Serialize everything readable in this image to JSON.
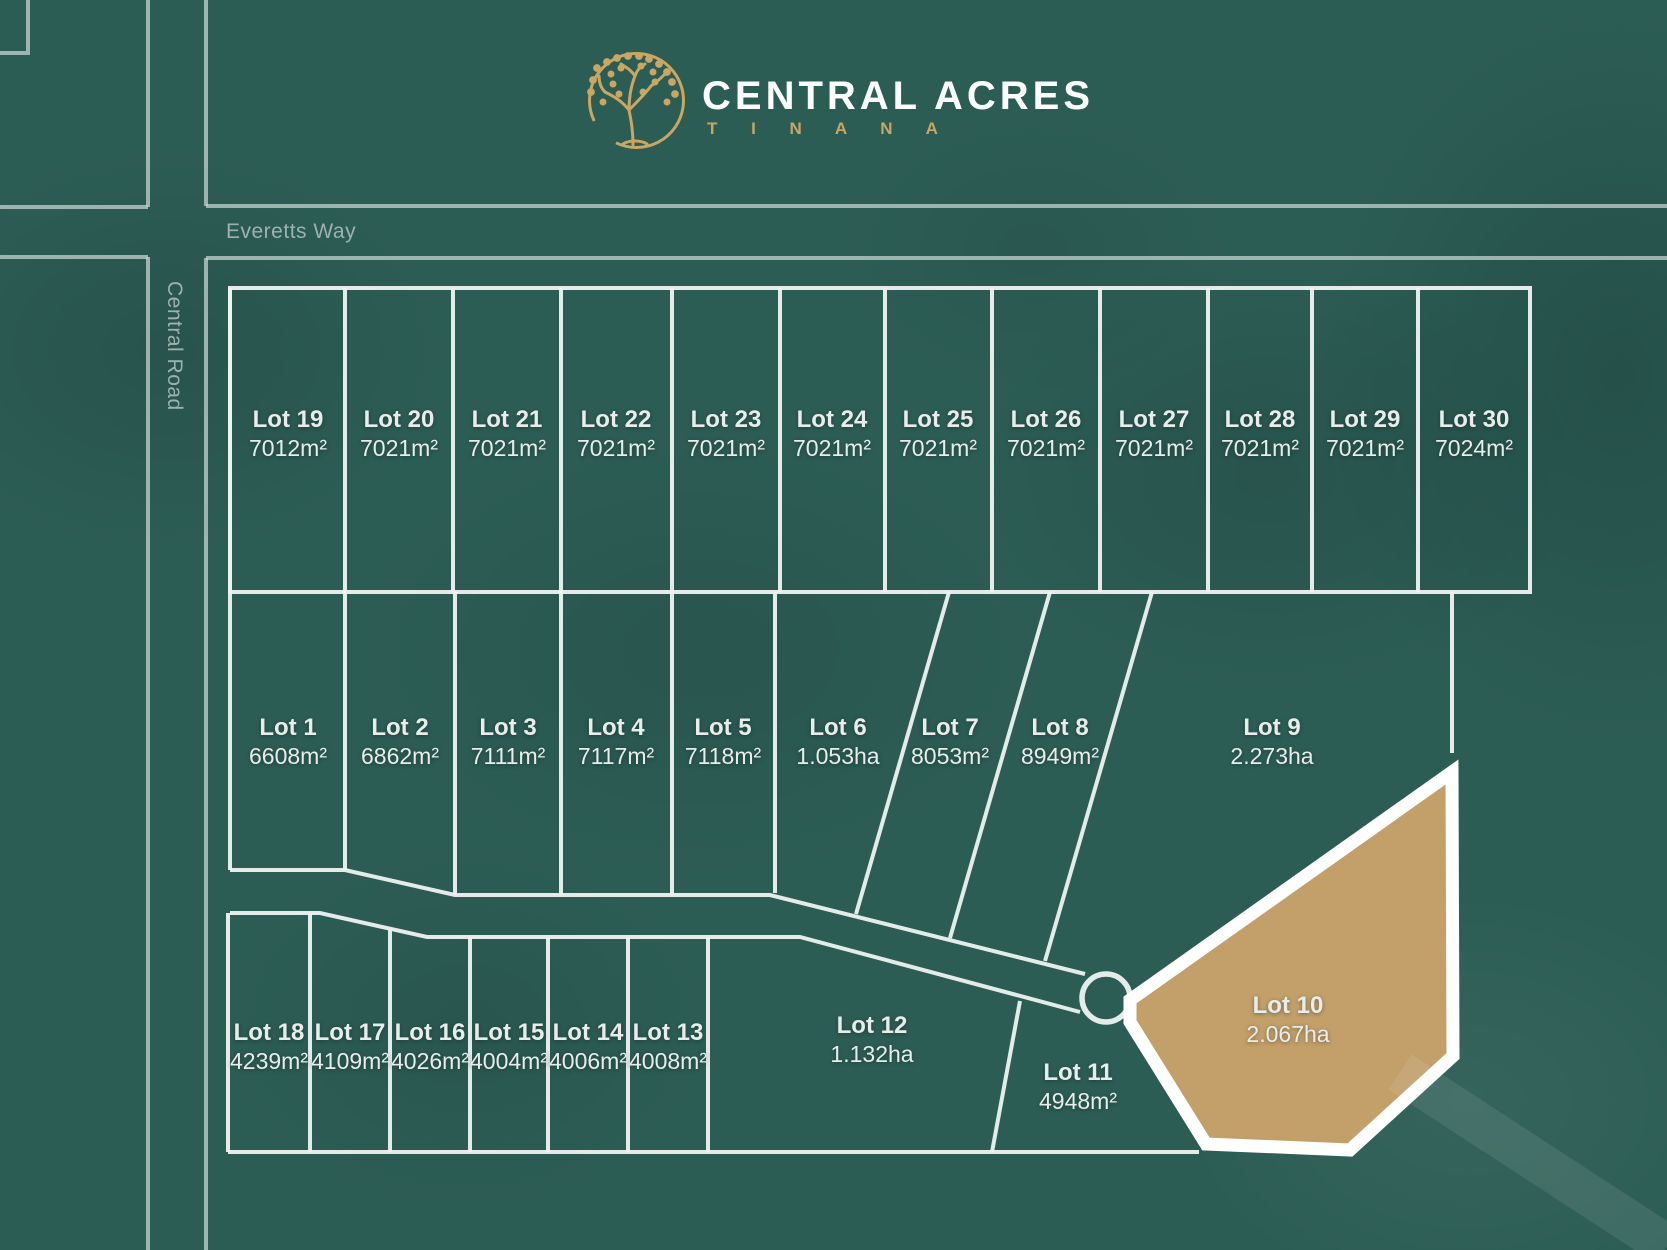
{
  "brand": {
    "title": "CENTRAL ACRES",
    "subtitle": "T I N A N A",
    "logo_icon": "tree-in-circle-icon",
    "gold": "#c9a662"
  },
  "roads": {
    "horizontal_label": "Everetts Way",
    "vertical_label": "Central Road"
  },
  "colors": {
    "background": "#2c5d55",
    "lot_boundary_line": "#eef3f2",
    "road_edge_line": "#c3d2cf",
    "road_label_text": "#9db2ae",
    "lot_label_text": "#e8edeb",
    "highlight_fill": "#c3a06a",
    "highlight_border": "#ffffff"
  },
  "lots": {
    "top": [
      {
        "name": "Lot 19",
        "area": "7012m²"
      },
      {
        "name": "Lot 20",
        "area": "7021m²"
      },
      {
        "name": "Lot 21",
        "area": "7021m²"
      },
      {
        "name": "Lot 22",
        "area": "7021m²"
      },
      {
        "name": "Lot 23",
        "area": "7021m²"
      },
      {
        "name": "Lot 24",
        "area": "7021m²"
      },
      {
        "name": "Lot 25",
        "area": "7021m²"
      },
      {
        "name": "Lot 26",
        "area": "7021m²"
      },
      {
        "name": "Lot 27",
        "area": "7021m²"
      },
      {
        "name": "Lot 28",
        "area": "7021m²"
      },
      {
        "name": "Lot 29",
        "area": "7021m²"
      },
      {
        "name": "Lot 30",
        "area": "7024m²"
      }
    ],
    "middle": [
      {
        "name": "Lot 1",
        "area": "6608m²"
      },
      {
        "name": "Lot 2",
        "area": "6862m²"
      },
      {
        "name": "Lot 3",
        "area": "7111m²"
      },
      {
        "name": "Lot 4",
        "area": "7117m²"
      },
      {
        "name": "Lot 5",
        "area": "7118m²"
      },
      {
        "name": "Lot 6",
        "area": "1.053ha"
      },
      {
        "name": "Lot 7",
        "area": "8053m²"
      },
      {
        "name": "Lot 8",
        "area": "8949m²"
      },
      {
        "name": "Lot 9",
        "area": "2.273ha"
      }
    ],
    "bottom": [
      {
        "name": "Lot 18",
        "area": "4239m²"
      },
      {
        "name": "Lot 17",
        "area": "4109m²"
      },
      {
        "name": "Lot 16",
        "area": "4026m²"
      },
      {
        "name": "Lot 15",
        "area": "4004m²"
      },
      {
        "name": "Lot 14",
        "area": "4006m²"
      },
      {
        "name": "Lot 13",
        "area": "4008m²"
      },
      {
        "name": "Lot 12",
        "area": "1.132ha"
      },
      {
        "name": "Lot 11",
        "area": "4948m²"
      }
    ],
    "highlight": {
      "name": "Lot 10",
      "area": "2.067ha"
    }
  }
}
